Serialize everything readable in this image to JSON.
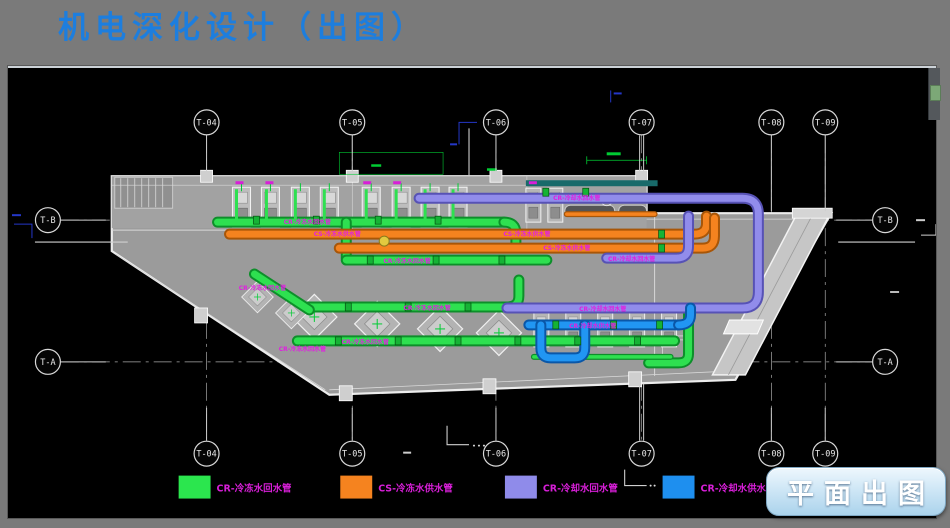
{
  "header": {
    "title": "机电深化设计（出图）"
  },
  "drawing": {
    "grid_columns": [
      "T-04",
      "T-05",
      "T-06",
      "T-07",
      "T-08",
      "T-09"
    ],
    "grid_rows": [
      "T-B",
      "T-A"
    ],
    "pipe_tags": [
      "CR-冷冻水回水管",
      "CS-冷冻水供水管",
      "CS-冷冻水供水管",
      "CS-冷冻水供水管",
      "CR-冷冻水回水管",
      "CR-冷却水回水管",
      "CR-冷却水回水管",
      "CR-冷冻水回水管",
      "CR-冷却水回水管",
      "CR-冷冻水回水管",
      "CR-冷却水供水管",
      "CR-冷冻水回水管",
      "CR-冷冻水回水管"
    ]
  },
  "legend": {
    "items": [
      {
        "label": "CR-冷冻水回水管",
        "color": "#2BE64E"
      },
      {
        "label": "CS-冷冻水供水管",
        "color": "#F5831F"
      },
      {
        "label": "CR-冷却水回水管",
        "color": "#8F8BEA"
      },
      {
        "label": "CR-冷却水供水管",
        "color": "#1E8FEF"
      }
    ]
  },
  "actions": {
    "plan_export_label": "平面出图"
  },
  "colors": {
    "title": "#1D7EDE",
    "tag_text": "#E020E0",
    "chilled_water_return": "#2BE64E",
    "chilled_water_supply": "#F5831F",
    "cooling_water_return": "#8F8BEA",
    "cooling_water_supply": "#1E8FEF"
  }
}
